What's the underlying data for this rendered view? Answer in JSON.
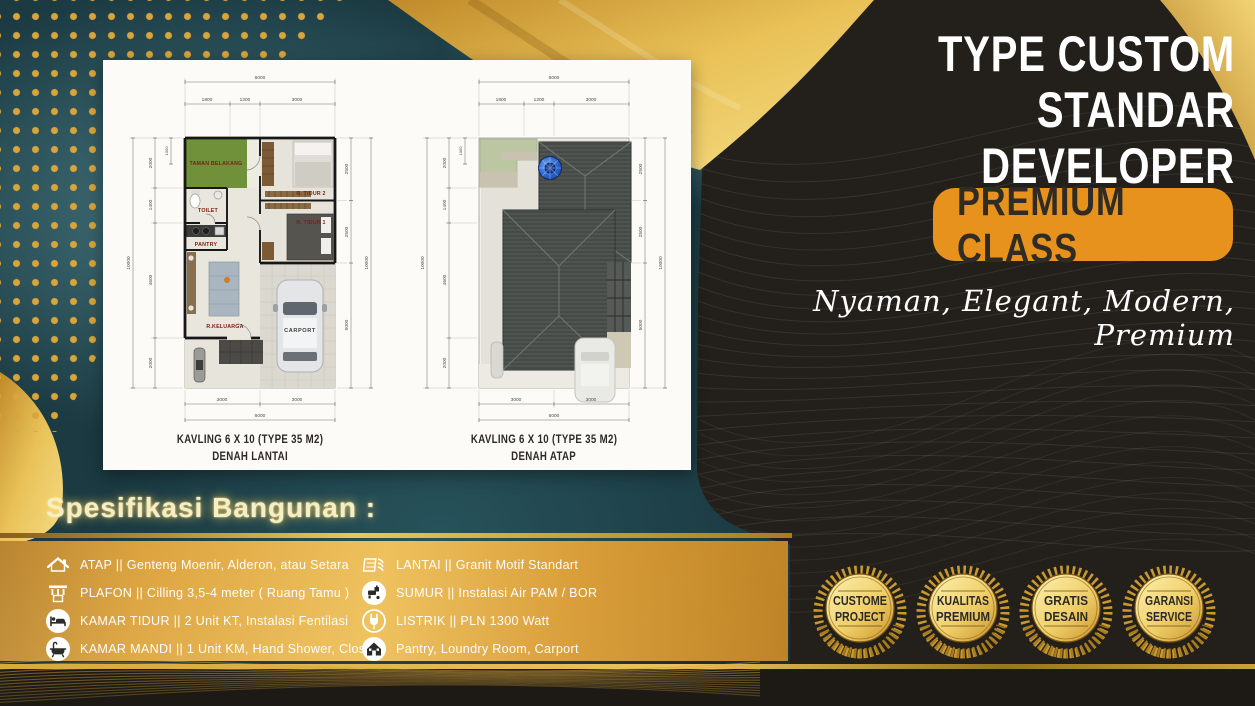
{
  "header": {
    "title_line1": "TYPE CUSTOM",
    "title_line2": "STANDAR DEVELOPER",
    "class_badge": "PREMIUM CLASS",
    "tagline": "Nyaman, Elegant, Modern, Premium"
  },
  "plans": [
    {
      "caption_line1": "KAVLING 6 X 10 (TYPE 35 M2)",
      "caption_line2": "DENAH LANTAI",
      "dims": {
        "top_total": "6000",
        "top_segments": [
          "1800",
          "1200",
          "3000"
        ],
        "left_outer": "10000",
        "left_segments": [
          "2000",
          "1400",
          "4600",
          "2000"
        ],
        "left_sub": "1050",
        "right_segments": [
          "2500",
          "2500",
          "5000"
        ],
        "right_outer": "10000",
        "bottom_segments": [
          "3000",
          "3000"
        ],
        "bottom_total": "6000"
      },
      "rooms": [
        "TAMAN BELAKANG",
        "R. TIDUR 2",
        "TOILET",
        "PANTRY",
        "R. TIDUR 1",
        "R.KELUARGA",
        "CARPORT"
      ]
    },
    {
      "caption_line1": "KAVLING 6 X 10 (TYPE 35 M2)",
      "caption_line2": "DENAH ATAP",
      "dims": {
        "top_total": "6000",
        "top_segments": [
          "1800",
          "1200",
          "3000"
        ],
        "left_outer": "10000",
        "left_segments": [
          "2000",
          "1400",
          "4600",
          "2000"
        ],
        "left_sub": "1050",
        "right_segments": [
          "2500",
          "2500",
          "5000"
        ],
        "right_outer": "10000",
        "bottom_segments": [
          "3000",
          "3000"
        ],
        "bottom_total": "6000"
      }
    }
  ],
  "spec": {
    "heading": "Spesifikasi Bangunan :",
    "left_items": [
      {
        "icon": "roof-icon",
        "text": "ATAP || Genteng Moenir, Alderon, atau Setara"
      },
      {
        "icon": "ceiling-icon",
        "text": "PLAFON ||  Cilling 3,5-4 meter ( Ruang Tamu )"
      },
      {
        "icon": "bed-icon",
        "text": "KAMAR TIDUR || 2 Unit KT, Instalasi Fentilasi"
      },
      {
        "icon": "bathtub-icon",
        "text": "KAMAR MANDI || 1 Unit KM, Hand Shower, Closed"
      }
    ],
    "right_items": [
      {
        "icon": "floor-tile-icon",
        "text": "LANTAI ||  Granit Motif Standart"
      },
      {
        "icon": "faucet-icon",
        "text": "SUMUR || Instalasi Air PAM / BOR"
      },
      {
        "icon": "plug-icon",
        "text": "LISTRIK ||  PLN 1300 Watt"
      },
      {
        "icon": "house-icon",
        "text": "Pantry, Loundry Room, Carport"
      }
    ]
  },
  "medals": [
    {
      "line1": "CUSTOME",
      "line2": "PROJECT"
    },
    {
      "line1": "KUALITAS",
      "line2": "PREMIUM"
    },
    {
      "line1": "GRATIS",
      "line2": "DESAIN"
    },
    {
      "line1": "GARANSI",
      "line2": "SERVICE"
    }
  ],
  "colors": {
    "gold": "#d9a43a",
    "gold_light": "#f2d474",
    "orange": "#e8921e",
    "teal": "#1b3a42",
    "black_panel": "#23201b",
    "cream": "#f6eec6",
    "room_label": "#7d2014"
  }
}
